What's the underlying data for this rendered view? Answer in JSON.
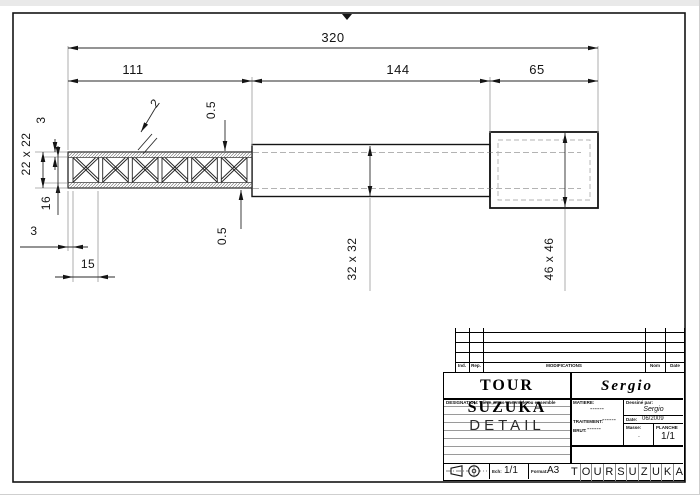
{
  "dims": {
    "total": "320",
    "left_segment": "111",
    "middle_segment": "144",
    "right_segment": "65",
    "beam_section": "22 x 22",
    "chord_thickness": "3",
    "web_height": "16",
    "end_post": "3",
    "cell_pitch": "15",
    "clearance_top": "0.5",
    "clearance_bottom": "0.5",
    "diagonal_thickness": "2",
    "tube_section": "32 x 32",
    "sleeve_section": "46 x 46"
  },
  "title_block": {
    "project": "TOUR SUZUKA",
    "author": "Sergio",
    "revision_headers": [
      "Ind.",
      "Rep.",
      "MODIFICATIONS",
      "Nom",
      "Date"
    ],
    "designation_label": "DESIGNATION: Pièce, sous-ensemble ou ensemble",
    "drawing_title": "DETAIL",
    "matiere_label": "MATIERE:",
    "matiere_value": "------",
    "traitement_label": "TRAITEMENT:",
    "traitement_value": "------",
    "brut_label": "BRUT:",
    "brut_value": "------",
    "drawn_by_label": "Dessiné par:",
    "drawn_by_value": "Sergio",
    "date_label": "Date:",
    "date_value": "06/2009",
    "masse_label": "Masse:",
    "masse_value": ".",
    "planche_label": "PLANCHE",
    "planche_value": "1/1",
    "scale_label": "Ech:",
    "scale_value": "1/1",
    "format_label": "Format:",
    "format_value": "A3",
    "footer_letters": [
      "T",
      "O",
      "U",
      "R",
      "S",
      "U",
      "Z",
      "U",
      "K",
      "A"
    ]
  }
}
